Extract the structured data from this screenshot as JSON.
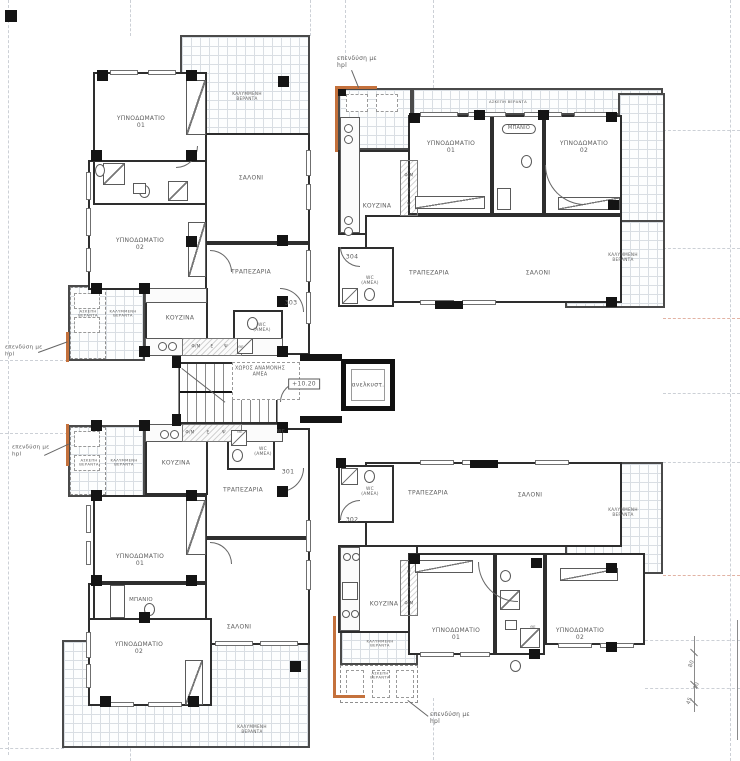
{
  "plan": {
    "type": "architectural floor plan",
    "level_marker": "+10.20",
    "unit_numbers": [
      "301",
      "302",
      "303",
      "304"
    ],
    "colors": {
      "wall": "#2e2e2e",
      "tile_grid": "#d9dee3",
      "hpl_accent": "#c4713c",
      "axis": "#ccd0d6",
      "axis_warm": "#e2b3a4",
      "text": "#5d5d5d"
    }
  },
  "labels": [
    {
      "name": "note-hpl-top",
      "text": "επενδύση με\nhpl",
      "x": 337,
      "y": 62,
      "size": 6,
      "cls": "left"
    },
    {
      "name": "room-label-veranda-covered-303-top",
      "text": "ΚΑΛΥΜΜΕΝΗ\nΒΕΡΑΝΤΑ",
      "x": 247,
      "y": 97,
      "size": 4.2
    },
    {
      "name": "room-label-bedroom1-303",
      "text": "ΥΠΝΟΔΩΜΑΤΙΟ\n01",
      "x": 141,
      "y": 122,
      "size": 6
    },
    {
      "name": "room-label-bedroom2-303",
      "text": "ΥΠΝΟΔΩΜΑΤΙΟ\n02",
      "x": 140,
      "y": 244,
      "size": 6
    },
    {
      "name": "room-label-living-303",
      "text": "ΣΑΛΟΝΙ",
      "x": 251,
      "y": 178,
      "size": 6
    },
    {
      "name": "room-label-dining-303",
      "text": "ΤΡΑΠΕΖΑΡΙΑ",
      "x": 251,
      "y": 272,
      "size": 6
    },
    {
      "name": "room-label-veranda-open-303",
      "text": "ΑΣΚΕΠΗ\nΒΕΡΑΝΤΑ",
      "x": 88,
      "y": 314,
      "size": 3.8
    },
    {
      "name": "room-label-veranda-covered-303-side",
      "text": "ΚΑΛΥΜΜΕΝΗ\nΒΕΡΑΝΤΑ",
      "x": 123,
      "y": 314,
      "size": 3.8
    },
    {
      "name": "room-label-kitchen-303",
      "text": "ΚΟΥΖΙΝΑ",
      "x": 180,
      "y": 318,
      "size": 6
    },
    {
      "name": "appliance-fm-303",
      "text": "Φ/Μ",
      "x": 196,
      "y": 347,
      "size": 4.3
    },
    {
      "name": "appliance-e-303",
      "text": "Ε",
      "x": 212,
      "y": 347,
      "size": 4.3
    },
    {
      "name": "appliance-psi-303",
      "text": "Ψ",
      "x": 226,
      "y": 347,
      "size": 4.3
    },
    {
      "name": "shower-tag-303",
      "text": "ΘΕ",
      "x": 241,
      "y": 347,
      "size": 3.6
    },
    {
      "name": "room-label-wc-amea-303",
      "text": "WC\n(ΑΜΕΑ)",
      "x": 262,
      "y": 328,
      "size": 4.4
    },
    {
      "name": "unit-number-303",
      "text": "303",
      "x": 291,
      "y": 303,
      "size": 6.2
    },
    {
      "name": "label-waiting-area-amea",
      "text": "ΧΩΡΟΣ ΑΝΑΜΟΝΗΣ\nΑΜΕΑ",
      "x": 260,
      "y": 372,
      "size": 4.8
    },
    {
      "name": "level-marker",
      "text": "+10.20",
      "x": 304,
      "y": 384,
      "size": 6,
      "cls": "boxed"
    },
    {
      "name": "label-elevator",
      "text": "ανελκυστ.",
      "x": 368,
      "y": 385,
      "size": 6
    },
    {
      "name": "appliance-fm-301",
      "text": "Φ/Μ",
      "x": 190,
      "y": 433,
      "size": 4.3
    },
    {
      "name": "appliance-e-301",
      "text": "Ε",
      "x": 208,
      "y": 433,
      "size": 4.3
    },
    {
      "name": "appliance-psi-301",
      "text": "Ψ",
      "x": 224,
      "y": 433,
      "size": 4.3
    },
    {
      "name": "shower-tag-301",
      "text": "ΘΕ",
      "x": 240,
      "y": 432,
      "size": 3.6
    },
    {
      "name": "label-wc-301-small",
      "text": "WC",
      "x": 281,
      "y": 432,
      "size": 4.4
    },
    {
      "name": "room-label-wc-amea-301",
      "text": "WC\n(ΑΜΕΑ)",
      "x": 263,
      "y": 452,
      "size": 4.4
    },
    {
      "name": "unit-number-301",
      "text": "301",
      "x": 288,
      "y": 472,
      "size": 6.2
    },
    {
      "name": "room-label-veranda-open-301",
      "text": "ΑΣΚΕΠΗ\nΒΕΡΑΝΤΑ",
      "x": 89,
      "y": 463,
      "size": 3.8
    },
    {
      "name": "room-label-veranda-covered-301-side",
      "text": "ΚΑΛΥΜΜΕΝΗ\nΒΕΡΑΝΤΑ",
      "x": 124,
      "y": 463,
      "size": 3.8
    },
    {
      "name": "room-label-kitchen-301",
      "text": "ΚΟΥΖΙΝΑ",
      "x": 176,
      "y": 463,
      "size": 6
    },
    {
      "name": "room-label-dining-301",
      "text": "ΤΡΑΠΕΖΑΡΙΑ",
      "x": 243,
      "y": 490,
      "size": 6
    },
    {
      "name": "room-label-bedroom1-301",
      "text": "ΥΠΝΟΔΩΜΑΤΙΟ\n01",
      "x": 140,
      "y": 560,
      "size": 6
    },
    {
      "name": "room-label-bath-301",
      "text": "ΜΠΑΝΙΟ",
      "x": 141,
      "y": 600,
      "size": 5.4
    },
    {
      "name": "room-label-bedroom2-301",
      "text": "ΥΠΝΟΔΩΜΑΤΙΟ\n02",
      "x": 139,
      "y": 648,
      "size": 6
    },
    {
      "name": "room-label-living-301",
      "text": "ΣΑΛΟΝΙ",
      "x": 239,
      "y": 627,
      "size": 6
    },
    {
      "name": "room-label-veranda-covered-301-bottom",
      "text": "ΚΑΛΥΜΜΕΝΗ\nΒΕΡΑΝΤΑ",
      "x": 252,
      "y": 730,
      "size": 4.2
    },
    {
      "name": "room-label-veranda-open-304",
      "text": "ΑΣΚΕΠΗ ΒΕΡΑΝΤΑ",
      "x": 508,
      "y": 102,
      "size": 3.8
    },
    {
      "name": "room-label-bedroom1-304",
      "text": "ΥΠΝΟΔΩΜΑΤΙΟ\n01",
      "x": 451,
      "y": 147,
      "size": 6
    },
    {
      "name": "room-label-bath-304",
      "text": "ΜΠΑΝΙΟ",
      "x": 519,
      "y": 129,
      "size": 5,
      "cls": "pill"
    },
    {
      "name": "room-label-bedroom2-304",
      "text": "ΥΠΝΟΔΩΜΑΤΙΟ\n02",
      "x": 584,
      "y": 147,
      "size": 6
    },
    {
      "name": "room-label-kitchen-304",
      "text": "ΚΟΥΖΙΝΑ",
      "x": 377,
      "y": 206,
      "size": 6
    },
    {
      "name": "appliance-fm-304",
      "text": "Φ/Μ",
      "x": 409,
      "y": 176,
      "size": 4.3
    },
    {
      "name": "appliance-e-304",
      "text": "Ε",
      "x": 409,
      "y": 191,
      "size": 4.3
    },
    {
      "name": "appliance-psi-304",
      "text": "Ψ",
      "x": 409,
      "y": 205,
      "size": 4.3
    },
    {
      "name": "unit-number-304",
      "text": "304",
      "x": 352,
      "y": 257,
      "size": 6.2
    },
    {
      "name": "room-label-wc-amea-304",
      "text": "WC\n(ΑΜΕΑ)",
      "x": 370,
      "y": 281,
      "size": 4.4
    },
    {
      "name": "room-label-dining-304",
      "text": "ΤΡΑΠΕΖΑΡΙΑ",
      "x": 429,
      "y": 273,
      "size": 6
    },
    {
      "name": "room-label-living-304",
      "text": "ΣΑΛΟΝΙ",
      "x": 538,
      "y": 273,
      "size": 6
    },
    {
      "name": "room-label-veranda-covered-304",
      "text": "ΚΑΛΥΜΜΕΝΗ\nΒΕΡΑΝΤΑ",
      "x": 623,
      "y": 258,
      "size": 4.2
    },
    {
      "name": "unit-number-302",
      "text": "302",
      "x": 352,
      "y": 520,
      "size": 6.2
    },
    {
      "name": "room-label-wc-amea-302",
      "text": "WC\n(ΑΜΕΑ)",
      "x": 370,
      "y": 492,
      "size": 4.4
    },
    {
      "name": "room-label-dining-302",
      "text": "ΤΡΑΠΕΖΑΡΙΑ",
      "x": 428,
      "y": 493,
      "size": 6
    },
    {
      "name": "room-label-living-302",
      "text": "ΣΑΛΟΝΙ",
      "x": 530,
      "y": 495,
      "size": 6
    },
    {
      "name": "room-label-veranda-covered-302",
      "text": "ΚΑΛΥΜΜΕΝΗ\nΒΕΡΑΝΤΑ",
      "x": 623,
      "y": 513,
      "size": 4.2
    },
    {
      "name": "room-label-kitchen-302",
      "text": "ΚΟΥΖΙΝΑ",
      "x": 384,
      "y": 604,
      "size": 6
    },
    {
      "name": "appliance-psi-302",
      "text": "Ψ",
      "x": 409,
      "y": 573,
      "size": 4.3
    },
    {
      "name": "appliance-e-302",
      "text": "Ε",
      "x": 409,
      "y": 589,
      "size": 4.3
    },
    {
      "name": "appliance-fm-302",
      "text": "Φ/Μ",
      "x": 409,
      "y": 604,
      "size": 4.3
    },
    {
      "name": "shower-tag-302",
      "text": "ΘΕ",
      "x": 533,
      "y": 627,
      "size": 3.6
    },
    {
      "name": "room-label-bedroom1-302",
      "text": "ΥΠΝΟΔΩΜΑΤΙΟ\n01",
      "x": 456,
      "y": 634,
      "size": 6
    },
    {
      "name": "room-label-bedroom2-302",
      "text": "ΥΠΝΟΔΩΜΑΤΙΟ\n02",
      "x": 580,
      "y": 634,
      "size": 6
    },
    {
      "name": "room-label-veranda-covered-302-small",
      "text": "ΚΑΛΥΜΜΕΝΗ\nΒΕΡΑΝΤΑ",
      "x": 380,
      "y": 644,
      "size": 3.8
    },
    {
      "name": "room-label-veranda-open-302-small",
      "text": "ΑΣΚΕΠΗ\nΒΕΡΑΝΤΑ",
      "x": 380,
      "y": 676,
      "size": 3.8
    },
    {
      "name": "note-hpl-bottom",
      "text": "επενδύση με\nhpl",
      "x": 430,
      "y": 718,
      "size": 6,
      "cls": "left"
    },
    {
      "name": "note-hpl-left-upper",
      "text": "επενδύση με\nhpl",
      "x": 5,
      "y": 351,
      "size": 5.6,
      "cls": "left"
    },
    {
      "name": "note-hpl-left-lower",
      "text": "επενδύση με\nhpl",
      "x": 12,
      "y": 451,
      "size": 5.6,
      "cls": "left"
    },
    {
      "name": "dim-80",
      "text": "80",
      "x": 692,
      "y": 664,
      "size": 5.4,
      "cls": "dim",
      "rot": -70
    },
    {
      "name": "dim-70",
      "text": "70",
      "x": 697,
      "y": 686,
      "size": 5.4,
      "cls": "dim",
      "rot": -70
    },
    {
      "name": "dim-45",
      "text": "45",
      "x": 690,
      "y": 701,
      "size": 5.4,
      "cls": "dim",
      "rot": -70
    }
  ]
}
